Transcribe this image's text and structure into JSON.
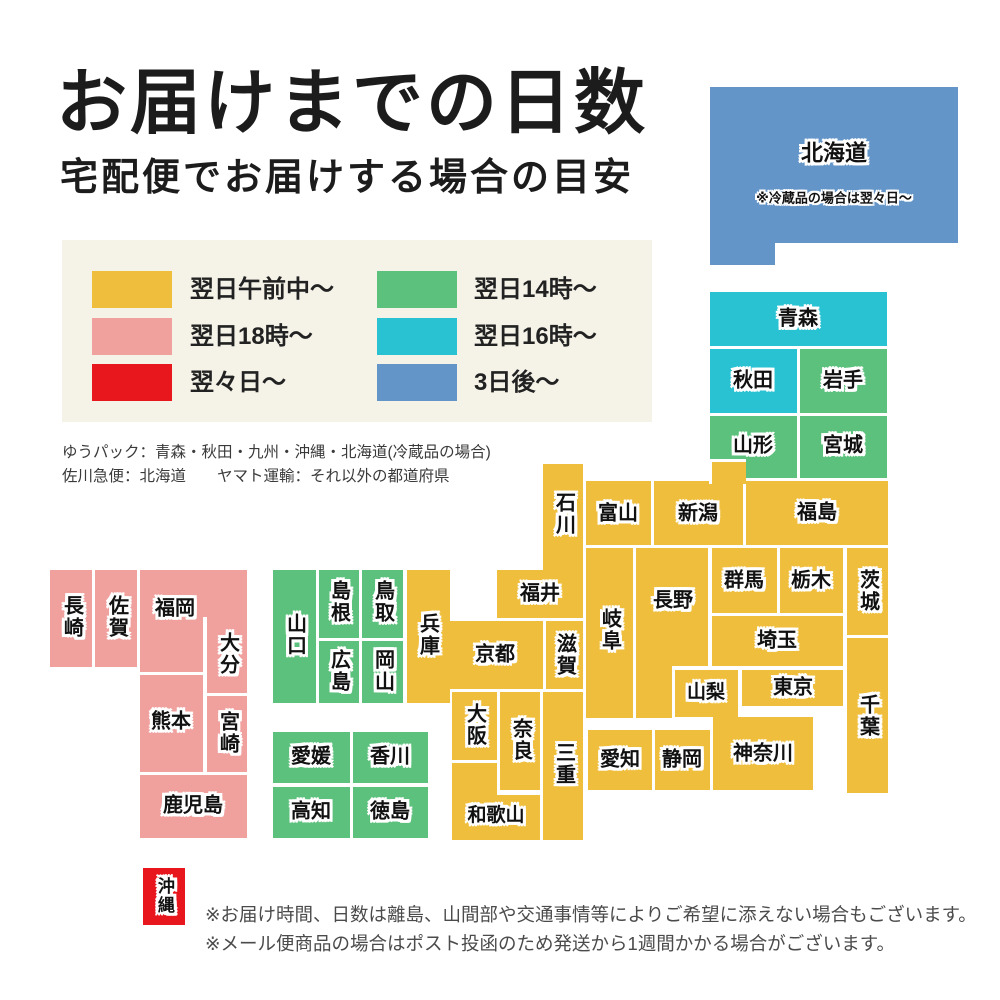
{
  "title": "お届けまでの日数",
  "subtitle": "宅配便でお届けする場合の目安",
  "legend": {
    "background": "#f5f2e8",
    "items": [
      {
        "label": "翌日午前中〜",
        "color_key": "yellow",
        "col": 0,
        "row": 0
      },
      {
        "label": "翌日18時〜",
        "color_key": "pink",
        "col": 0,
        "row": 1
      },
      {
        "label": "翌々日〜",
        "color_key": "red",
        "col": 0,
        "row": 2
      },
      {
        "label": "翌日14時〜",
        "color_key": "green",
        "col": 1,
        "row": 0
      },
      {
        "label": "翌日16時〜",
        "color_key": "cyan",
        "col": 1,
        "row": 1
      },
      {
        "label": "3日後〜",
        "color_key": "blue",
        "col": 1,
        "row": 2
      }
    ]
  },
  "carrier_notes": [
    "ゆうパック：青森・秋田・九州・沖縄・北海道(冷蔵品の場合)",
    "佐川急便：北海道　　ヤマト運輸：それ以外の都道府県"
  ],
  "map": {
    "colors": {
      "yellow": "#efbe3d",
      "pink": "#f0a09d",
      "red": "#e8161d",
      "green": "#5cc17c",
      "cyan": "#29c2d2",
      "blue": "#6495c9"
    },
    "blocks": [
      {
        "id": "hokkaido",
        "name": "北海道",
        "color": "blue",
        "parts": [
          [
            710,
            87,
            248,
            156
          ],
          [
            710,
            243,
            65,
            22
          ]
        ],
        "label": [
          834,
          153
        ],
        "fs": 22,
        "note": "※冷蔵品の場合は翌々日〜",
        "note_pos": [
          834,
          197
        ]
      },
      {
        "id": "aomori",
        "name": "青森",
        "color": "cyan",
        "parts": [
          [
            710,
            292,
            177,
            54
          ]
        ],
        "label": [
          798,
          319
        ]
      },
      {
        "id": "akita",
        "name": "秋田",
        "color": "cyan",
        "parts": [
          [
            710,
            349,
            87,
            64
          ]
        ],
        "label": [
          753,
          381
        ]
      },
      {
        "id": "iwate",
        "name": "岩手",
        "color": "green",
        "parts": [
          [
            800,
            349,
            87,
            64
          ]
        ],
        "label": [
          843,
          381
        ]
      },
      {
        "id": "yamagata",
        "name": "山形",
        "color": "green",
        "parts": [
          [
            710,
            416,
            87,
            62
          ]
        ],
        "label": [
          753,
          446
        ]
      },
      {
        "id": "miyagi",
        "name": "宮城",
        "color": "green",
        "parts": [
          [
            800,
            416,
            87,
            62
          ]
        ],
        "label": [
          843,
          446
        ]
      },
      {
        "id": "fukushima",
        "name": "福島",
        "color": "yellow",
        "parts": [
          [
            746,
            481,
            142,
            64
          ]
        ],
        "label": [
          817,
          513
        ]
      },
      {
        "id": "niigata",
        "name": "新潟",
        "color": "yellow",
        "parts": [
          [
            654,
            481,
            89,
            64
          ],
          [
            709,
            459,
            37,
            25,
            "tl"
          ]
        ],
        "label": [
          698,
          514
        ]
      },
      {
        "id": "toyama",
        "name": "富山",
        "color": "yellow",
        "parts": [
          [
            586,
            481,
            65,
            64
          ]
        ],
        "label": [
          618,
          514
        ]
      },
      {
        "id": "ishikawa",
        "name": "石川",
        "color": "yellow",
        "parts": [
          [
            543,
            464,
            40,
            106
          ]
        ],
        "label": [
          563,
          514
        ],
        "v": true
      },
      {
        "id": "fukui",
        "name": "福井",
        "color": "yellow",
        "parts": [
          [
            497,
            570,
            86,
            48
          ]
        ],
        "label": [
          540,
          594
        ]
      },
      {
        "id": "gunma",
        "name": "群馬",
        "color": "yellow",
        "parts": [
          [
            712,
            548,
            65,
            65
          ]
        ],
        "label": [
          744,
          581
        ]
      },
      {
        "id": "tochigi",
        "name": "栃木",
        "color": "yellow",
        "parts": [
          [
            780,
            548,
            63,
            65
          ]
        ],
        "label": [
          811,
          581
        ]
      },
      {
        "id": "ibaraki",
        "name": "茨城",
        "color": "yellow",
        "parts": [
          [
            847,
            548,
            41,
            87
          ]
        ],
        "label": [
          867,
          591
        ],
        "v": true
      },
      {
        "id": "saitama",
        "name": "埼玉",
        "color": "yellow",
        "parts": [
          [
            712,
            616,
            131,
            50
          ]
        ],
        "label": [
          777,
          641
        ]
      },
      {
        "id": "chiba",
        "name": "千葉",
        "color": "yellow",
        "parts": [
          [
            847,
            638,
            41,
            155
          ]
        ],
        "label": [
          867,
          716
        ],
        "v": true
      },
      {
        "id": "tokyo",
        "name": "東京",
        "color": "yellow",
        "parts": [
          [
            742,
            670,
            101,
            36
          ]
        ],
        "label": [
          793,
          688
        ]
      },
      {
        "id": "yamanashi",
        "name": "山梨",
        "color": "yellow",
        "parts": [
          [
            675,
            670,
            63,
            47
          ]
        ],
        "label": [
          706,
          693
        ],
        "fs": 19
      },
      {
        "id": "nagano",
        "name": "長野",
        "color": "yellow",
        "parts": [
          [
            636,
            548,
            72,
            118
          ],
          [
            636,
            666,
            36,
            52
          ]
        ],
        "label": [
          673,
          601
        ]
      },
      {
        "id": "gifu",
        "name": "岐阜",
        "color": "yellow",
        "parts": [
          [
            586,
            548,
            47,
            170
          ]
        ],
        "label": [
          609,
          630
        ],
        "v": true
      },
      {
        "id": "kanagawa",
        "name": "神奈川",
        "color": "yellow",
        "parts": [
          [
            713,
            717,
            100,
            73
          ]
        ],
        "label": [
          763,
          754
        ]
      },
      {
        "id": "shizuoka",
        "name": "静岡",
        "color": "yellow",
        "parts": [
          [
            655,
            730,
            55,
            60
          ]
        ],
        "label": [
          682,
          760
        ]
      },
      {
        "id": "aichi",
        "name": "愛知",
        "color": "yellow",
        "parts": [
          [
            588,
            730,
            64,
            60
          ]
        ],
        "label": [
          620,
          760
        ]
      },
      {
        "id": "shiga",
        "name": "滋賀",
        "color": "yellow",
        "parts": [
          [
            546,
            621,
            37,
            68
          ]
        ],
        "label": [
          564,
          655
        ],
        "v": true
      },
      {
        "id": "kyoto",
        "name": "京都",
        "color": "yellow",
        "parts": [
          [
            448,
            621,
            95,
            68
          ]
        ],
        "label": [
          495,
          655
        ]
      },
      {
        "id": "hyogo",
        "name": "兵庫",
        "color": "yellow",
        "parts": [
          [
            407,
            570,
            43,
            133
          ]
        ],
        "label": [
          427,
          635
        ],
        "v": true
      },
      {
        "id": "osaka",
        "name": "大阪",
        "color": "yellow",
        "parts": [
          [
            452,
            692,
            45,
            68
          ]
        ],
        "label": [
          474,
          725
        ],
        "v": true
      },
      {
        "id": "nara",
        "name": "奈良",
        "color": "yellow",
        "parts": [
          [
            500,
            692,
            40,
            98
          ]
        ],
        "label": [
          520,
          740
        ],
        "v": true
      },
      {
        "id": "wakayama",
        "name": "和歌山",
        "color": "yellow",
        "parts": [
          [
            452,
            763,
            45,
            77
          ],
          [
            497,
            795,
            43,
            45
          ]
        ],
        "label": [
          496,
          816
        ],
        "fs": 19
      },
      {
        "id": "mie",
        "name": "三重",
        "color": "yellow",
        "parts": [
          [
            543,
            692,
            40,
            148
          ]
        ],
        "label": [
          563,
          764
        ],
        "v": true
      },
      {
        "id": "tottori",
        "name": "鳥取",
        "color": "green",
        "parts": [
          [
            362,
            570,
            41,
            68
          ]
        ],
        "label": [
          382,
          602
        ],
        "v": true
      },
      {
        "id": "shimane",
        "name": "島根",
        "color": "green",
        "parts": [
          [
            319,
            570,
            40,
            68
          ]
        ],
        "label": [
          338,
          602
        ],
        "v": true
      },
      {
        "id": "okayama",
        "name": "岡山",
        "color": "green",
        "parts": [
          [
            362,
            641,
            41,
            62
          ]
        ],
        "label": [
          382,
          671
        ],
        "v": true
      },
      {
        "id": "hiroshima",
        "name": "広島",
        "color": "green",
        "parts": [
          [
            319,
            641,
            40,
            62
          ]
        ],
        "label": [
          338,
          671
        ],
        "v": true
      },
      {
        "id": "yamaguchi",
        "name": "山口",
        "color": "green",
        "parts": [
          [
            273,
            570,
            43,
            133
          ]
        ],
        "label": [
          294,
          635
        ],
        "v": true
      },
      {
        "id": "ehime",
        "name": "愛媛",
        "color": "green",
        "parts": [
          [
            273,
            732,
            77,
            51
          ]
        ],
        "label": [
          311,
          757
        ]
      },
      {
        "id": "kagawa",
        "name": "香川",
        "color": "green",
        "parts": [
          [
            353,
            732,
            75,
            51
          ]
        ],
        "label": [
          390,
          757
        ]
      },
      {
        "id": "kochi",
        "name": "高知",
        "color": "green",
        "parts": [
          [
            273,
            787,
            77,
            51
          ]
        ],
        "label": [
          311,
          812
        ]
      },
      {
        "id": "tokushima",
        "name": "徳島",
        "color": "green",
        "parts": [
          [
            353,
            787,
            75,
            51
          ]
        ],
        "label": [
          390,
          812
        ]
      },
      {
        "id": "fukuoka",
        "name": "福岡",
        "color": "pink",
        "parts": [
          [
            140,
            570,
            107,
            47
          ],
          [
            140,
            617,
            63,
            55
          ]
        ],
        "label": [
          175,
          609
        ]
      },
      {
        "id": "saga",
        "name": "佐賀",
        "color": "pink",
        "parts": [
          [
            95,
            570,
            42,
            97
          ]
        ],
        "label": [
          116,
          617
        ],
        "v": true
      },
      {
        "id": "nagasaki",
        "name": "長崎",
        "color": "pink",
        "parts": [
          [
            50,
            570,
            42,
            97
          ]
        ],
        "label": [
          71,
          617
        ],
        "v": true
      },
      {
        "id": "oita",
        "name": "大分",
        "color": "pink",
        "parts": [
          [
            207,
            617,
            40,
            76
          ]
        ],
        "label": [
          227,
          654
        ],
        "v": true
      },
      {
        "id": "kumamoto",
        "name": "熊本",
        "color": "pink",
        "parts": [
          [
            140,
            675,
            63,
            97
          ]
        ],
        "label": [
          171,
          722
        ]
      },
      {
        "id": "miyazaki",
        "name": "宮崎",
        "color": "pink",
        "parts": [
          [
            207,
            696,
            40,
            76
          ]
        ],
        "label": [
          227,
          733
        ],
        "v": true
      },
      {
        "id": "kagoshima",
        "name": "鹿児島",
        "color": "pink",
        "parts": [
          [
            140,
            775,
            107,
            63
          ]
        ],
        "label": [
          193,
          806
        ]
      },
      {
        "id": "okinawa",
        "name": "沖縄",
        "color": "red",
        "parts": [
          [
            143,
            868,
            42,
            57
          ]
        ],
        "label": [
          164,
          896
        ],
        "v": true,
        "fs": 17
      }
    ]
  },
  "footer_notes": [
    "※お届け時間、日数は離島、山間部や交通事情等によりご希望に添えない場合もございます。",
    "※メール便商品の場合はポスト投函のため発送から1週間かかる場合がございます。"
  ]
}
